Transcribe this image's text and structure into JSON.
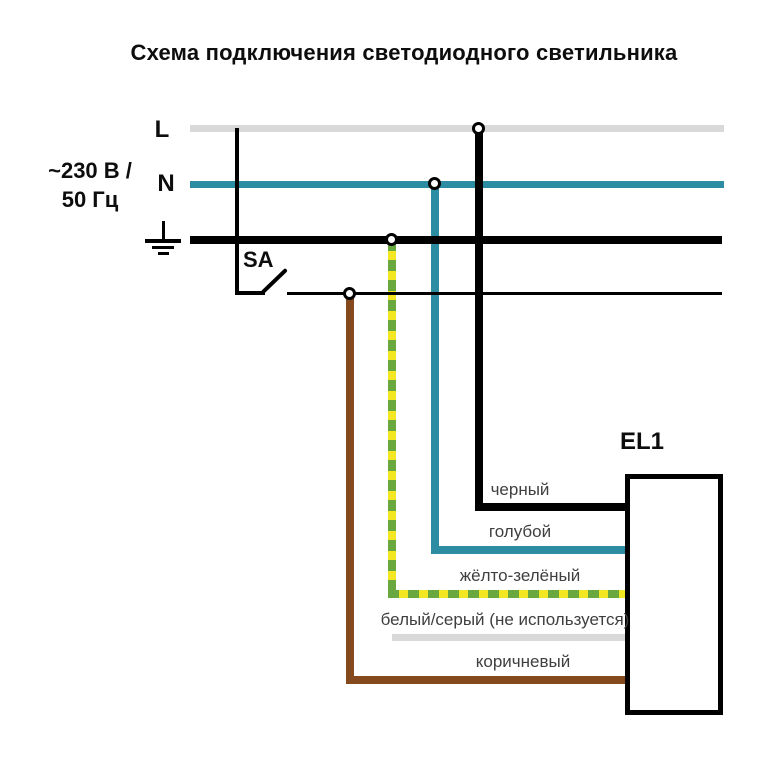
{
  "title": "Схема подключения светодиодного светильника",
  "supply": {
    "voltage_line1": "~230 В /",
    "voltage_line2": "50 Гц",
    "line_l_label": "L",
    "line_n_label": "N"
  },
  "switch": {
    "label": "SA"
  },
  "luminaire": {
    "label": "EL1"
  },
  "wires": [
    {
      "label": "черный",
      "color": "#000000"
    },
    {
      "label": "голубой",
      "color": "#2b8ca2"
    },
    {
      "label": "жёлто-зелёный",
      "colors": [
        "#f2e722",
        "#68a83e"
      ]
    },
    {
      "label": "белый/серый (не используется)",
      "color": "#d9d9d9"
    },
    {
      "label": "коричневый",
      "color": "#84491c"
    }
  ],
  "colors": {
    "black": "#000000",
    "gray": "#d9d9d9",
    "teal": "#2b8ca2",
    "yellow": "#f2e722",
    "green": "#68a83e",
    "brown": "#84491c",
    "label-text": "#3f3f3f",
    "background": "#ffffff"
  }
}
